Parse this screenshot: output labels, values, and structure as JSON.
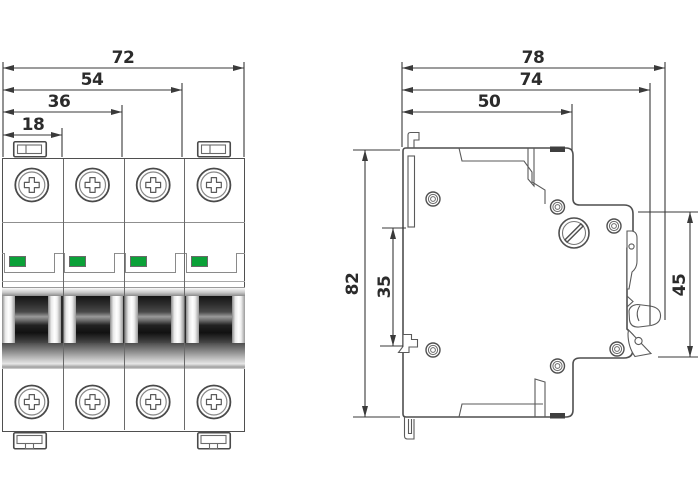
{
  "title": "circuit-breaker-dimension-drawing",
  "theme": {
    "line_color": "#4f4f4f",
    "dim_color": "#3a3a3a",
    "text_color": "#2b2b2b",
    "indicator_green": "#0ba138",
    "detail_gray": "#8a8a8a",
    "bg": "#ffffff"
  },
  "front_view": {
    "poles": 4,
    "dimensions": [
      {
        "label": "72"
      },
      {
        "label": "54"
      },
      {
        "label": "36"
      },
      {
        "label": "18"
      }
    ]
  },
  "side_view": {
    "dimensions_horizontal": [
      {
        "label": "78"
      },
      {
        "label": "74"
      },
      {
        "label": "50"
      }
    ],
    "dimensions_vertical": [
      {
        "label": "82"
      },
      {
        "label": "35"
      },
      {
        "label": "45"
      }
    ]
  }
}
